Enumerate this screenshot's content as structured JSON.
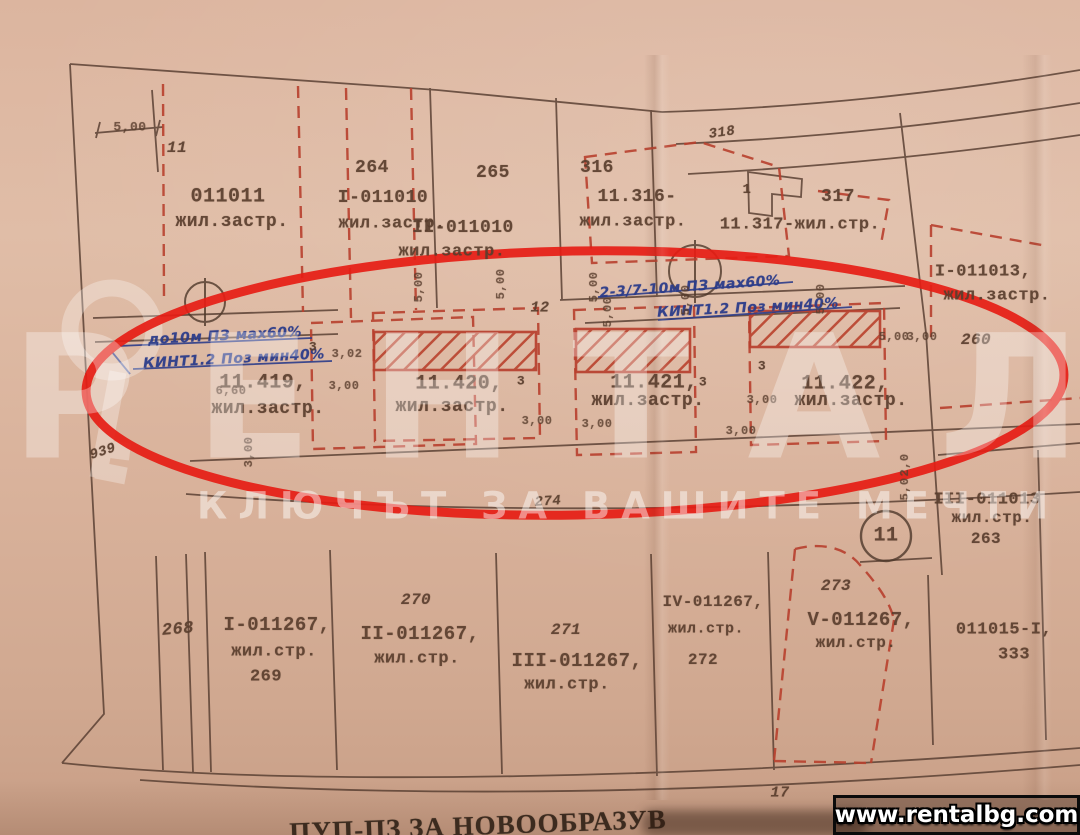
{
  "palette": {
    "paper": "#dcb59f",
    "print_line": "#5b4134",
    "regulation_red": "#b8402e",
    "ink_blue": "#2b3c8a",
    "highlight_red": "#e61d15"
  },
  "watermark": {
    "brand": "РЕНТАЛ",
    "tagline": "КЛЮЧЪТ ЗА ВАШИТЕ МЕЧТИ",
    "url": "www.rentalbg.com"
  },
  "footer": {
    "plan_title": "ПУП-ПЗ ЗА НОВООБРАЗУВ"
  },
  "labels": [
    {
      "t": "5,00",
      "x": 130,
      "y": 127,
      "s": 13,
      "k": "dim"
    },
    {
      "t": "11",
      "x": 177,
      "y": 148,
      "s": 16,
      "k": "italic"
    },
    {
      "t": "011011",
      "x": 228,
      "y": 197,
      "s": 20,
      "k": "print"
    },
    {
      "t": "жил.застр.",
      "x": 232,
      "y": 222,
      "s": 18,
      "k": "print"
    },
    {
      "t": "264",
      "x": 372,
      "y": 168,
      "s": 18,
      "k": "print"
    },
    {
      "t": "I-011010",
      "x": 383,
      "y": 198,
      "s": 18,
      "k": "print"
    },
    {
      "t": "жил.застр.",
      "x": 392,
      "y": 224,
      "s": 17,
      "k": "print"
    },
    {
      "t": "265",
      "x": 493,
      "y": 173,
      "s": 18,
      "k": "print"
    },
    {
      "t": "II-011010",
      "x": 463,
      "y": 228,
      "s": 18,
      "k": "print"
    },
    {
      "t": "жил.застр.",
      "x": 452,
      "y": 252,
      "s": 17,
      "k": "print"
    },
    {
      "t": "316",
      "x": 597,
      "y": 168,
      "s": 18,
      "k": "print"
    },
    {
      "t": "11.316-",
      "x": 637,
      "y": 197,
      "s": 18,
      "k": "print"
    },
    {
      "t": "жил.застр.",
      "x": 633,
      "y": 222,
      "s": 17,
      "k": "print"
    },
    {
      "t": "318",
      "x": 722,
      "y": 133,
      "s": 14,
      "r": -8,
      "k": "italic"
    },
    {
      "t": "1",
      "x": 747,
      "y": 190,
      "s": 14,
      "k": "print"
    },
    {
      "t": "317",
      "x": 838,
      "y": 197,
      "s": 18,
      "k": "print"
    },
    {
      "t": "11.317-жил.стр.",
      "x": 800,
      "y": 225,
      "s": 17,
      "k": "print"
    },
    {
      "t": "I-011013,",
      "x": 983,
      "y": 272,
      "s": 17,
      "k": "print"
    },
    {
      "t": "жил.застр.",
      "x": 997,
      "y": 296,
      "s": 17,
      "k": "print"
    },
    {
      "t": "260",
      "x": 976,
      "y": 340,
      "s": 16,
      "k": "italic"
    },
    {
      "t": "до10м ПЗ мах60%",
      "x": 225,
      "y": 336,
      "s": 14,
      "r": -3,
      "k": "hand"
    },
    {
      "t": "КИНТ1.2 Поз мин40%",
      "x": 234,
      "y": 359,
      "s": 14,
      "r": -3,
      "k": "hand"
    },
    {
      "t": "2-3/7-10м ПЗ мах60%",
      "x": 690,
      "y": 287,
      "s": 14,
      "r": -4,
      "k": "hand"
    },
    {
      "t": "КИНТ1.2 Поз мин40%",
      "x": 748,
      "y": 308,
      "s": 14,
      "r": -3,
      "k": "hand"
    },
    {
      "t": "3",
      "x": 313,
      "y": 347,
      "s": 13,
      "k": "print"
    },
    {
      "t": "11.419,",
      "x": 263,
      "y": 383,
      "s": 20,
      "k": "print"
    },
    {
      "t": "жил.застр.",
      "x": 268,
      "y": 409,
      "s": 18,
      "k": "print"
    },
    {
      "t": "6,60",
      "x": 231,
      "y": 391,
      "s": 12,
      "k": "dim"
    },
    {
      "t": "939",
      "x": 103,
      "y": 452,
      "s": 14,
      "r": -18,
      "k": "italic"
    },
    {
      "t": "12",
      "x": 540,
      "y": 308,
      "s": 15,
      "k": "italic"
    },
    {
      "t": "11.420,",
      "x": 459,
      "y": 384,
      "s": 20,
      "k": "print"
    },
    {
      "t": "3",
      "x": 521,
      "y": 381,
      "s": 13,
      "k": "print"
    },
    {
      "t": "жил.застр.",
      "x": 452,
      "y": 407,
      "s": 18,
      "k": "print"
    },
    {
      "t": "11.421,",
      "x": 654,
      "y": 383,
      "s": 20,
      "k": "print"
    },
    {
      "t": "3",
      "x": 703,
      "y": 382,
      "s": 13,
      "k": "print"
    },
    {
      "t": "жил.застр.",
      "x": 648,
      "y": 401,
      "s": 18,
      "k": "print"
    },
    {
      "t": "3",
      "x": 762,
      "y": 366,
      "s": 13,
      "k": "print"
    },
    {
      "t": "11.422,",
      "x": 845,
      "y": 384,
      "s": 20,
      "k": "print"
    },
    {
      "t": "жил.застр.",
      "x": 851,
      "y": 401,
      "s": 18,
      "k": "print"
    },
    {
      "t": "3,02",
      "x": 347,
      "y": 354,
      "s": 12,
      "k": "dim"
    },
    {
      "t": "3,00",
      "x": 344,
      "y": 386,
      "s": 12,
      "k": "dim"
    },
    {
      "t": "5,00",
      "x": 419,
      "y": 287,
      "s": 12,
      "r": -90,
      "k": "dim"
    },
    {
      "t": "5,00",
      "x": 501,
      "y": 284,
      "s": 12,
      "r": -90,
      "k": "dim"
    },
    {
      "t": "5,00",
      "x": 594,
      "y": 287,
      "s": 12,
      "r": -90,
      "k": "dim"
    },
    {
      "t": "5,00",
      "x": 608,
      "y": 312,
      "s": 12,
      "r": -90,
      "k": "dim"
    },
    {
      "t": "5,00",
      "x": 686,
      "y": 300,
      "s": 12,
      "r": -90,
      "k": "dim"
    },
    {
      "t": "5,00",
      "x": 821,
      "y": 299,
      "s": 12,
      "r": -90,
      "k": "dim"
    },
    {
      "t": "5,00",
      "x": 894,
      "y": 337,
      "s": 12,
      "k": "dim"
    },
    {
      "t": "3,00",
      "x": 922,
      "y": 337,
      "s": 12,
      "k": "dim"
    },
    {
      "t": "3,00",
      "x": 537,
      "y": 421,
      "s": 12,
      "k": "dim"
    },
    {
      "t": "3,00",
      "x": 597,
      "y": 424,
      "s": 12,
      "k": "dim"
    },
    {
      "t": "3,00",
      "x": 741,
      "y": 431,
      "s": 12,
      "k": "dim"
    },
    {
      "t": "3,00",
      "x": 762,
      "y": 400,
      "s": 12,
      "k": "dim"
    },
    {
      "t": "3,00",
      "x": 249,
      "y": 452,
      "s": 12,
      "r": -90,
      "k": "dim"
    },
    {
      "t": "2,0",
      "x": 905,
      "y": 465,
      "s": 12,
      "r": -90,
      "k": "dim"
    },
    {
      "t": "5,0",
      "x": 905,
      "y": 489,
      "s": 12,
      "r": -90,
      "k": "dim"
    },
    {
      "t": "274",
      "x": 548,
      "y": 502,
      "s": 14,
      "r": -4,
      "k": "italic"
    },
    {
      "t": "III-011013",
      "x": 987,
      "y": 500,
      "s": 17,
      "k": "print"
    },
    {
      "t": "жил.стр.",
      "x": 992,
      "y": 518,
      "s": 16,
      "k": "print"
    },
    {
      "t": "263",
      "x": 986,
      "y": 539,
      "s": 16,
      "k": "print"
    },
    {
      "t": "11",
      "x": 886,
      "y": 536,
      "s": 20,
      "k": "print"
    },
    {
      "t": "268",
      "x": 178,
      "y": 630,
      "s": 17,
      "r": -5,
      "k": "italic"
    },
    {
      "t": "I-011267,",
      "x": 277,
      "y": 625,
      "s": 19,
      "k": "print"
    },
    {
      "t": "жил.стр.",
      "x": 274,
      "y": 652,
      "s": 17,
      "k": "print"
    },
    {
      "t": "269",
      "x": 266,
      "y": 677,
      "s": 17,
      "k": "print"
    },
    {
      "t": "270",
      "x": 416,
      "y": 600,
      "s": 16,
      "k": "italic"
    },
    {
      "t": "II-011267,",
      "x": 420,
      "y": 634,
      "s": 19,
      "k": "print"
    },
    {
      "t": "жил.стр.",
      "x": 417,
      "y": 659,
      "s": 17,
      "k": "print"
    },
    {
      "t": "271",
      "x": 566,
      "y": 630,
      "s": 16,
      "k": "italic"
    },
    {
      "t": "III-011267,",
      "x": 577,
      "y": 661,
      "s": 19,
      "k": "print"
    },
    {
      "t": "жил.стр.",
      "x": 567,
      "y": 685,
      "s": 17,
      "k": "print"
    },
    {
      "t": "IV-011267,",
      "x": 713,
      "y": 602,
      "s": 16,
      "k": "print"
    },
    {
      "t": "жил.стр.",
      "x": 706,
      "y": 629,
      "s": 15,
      "k": "print"
    },
    {
      "t": "272",
      "x": 703,
      "y": 660,
      "s": 16,
      "k": "print"
    },
    {
      "t": "273",
      "x": 836,
      "y": 586,
      "s": 16,
      "k": "italic"
    },
    {
      "t": "V-011267,",
      "x": 861,
      "y": 620,
      "s": 19,
      "k": "print"
    },
    {
      "t": "жил.стр.",
      "x": 856,
      "y": 643,
      "s": 16,
      "k": "print"
    },
    {
      "t": "011015-I,",
      "x": 1004,
      "y": 630,
      "s": 17,
      "k": "print"
    },
    {
      "t": "333",
      "x": 1014,
      "y": 655,
      "s": 17,
      "k": "print"
    },
    {
      "t": "17",
      "x": 780,
      "y": 793,
      "s": 15,
      "k": "italic"
    }
  ]
}
